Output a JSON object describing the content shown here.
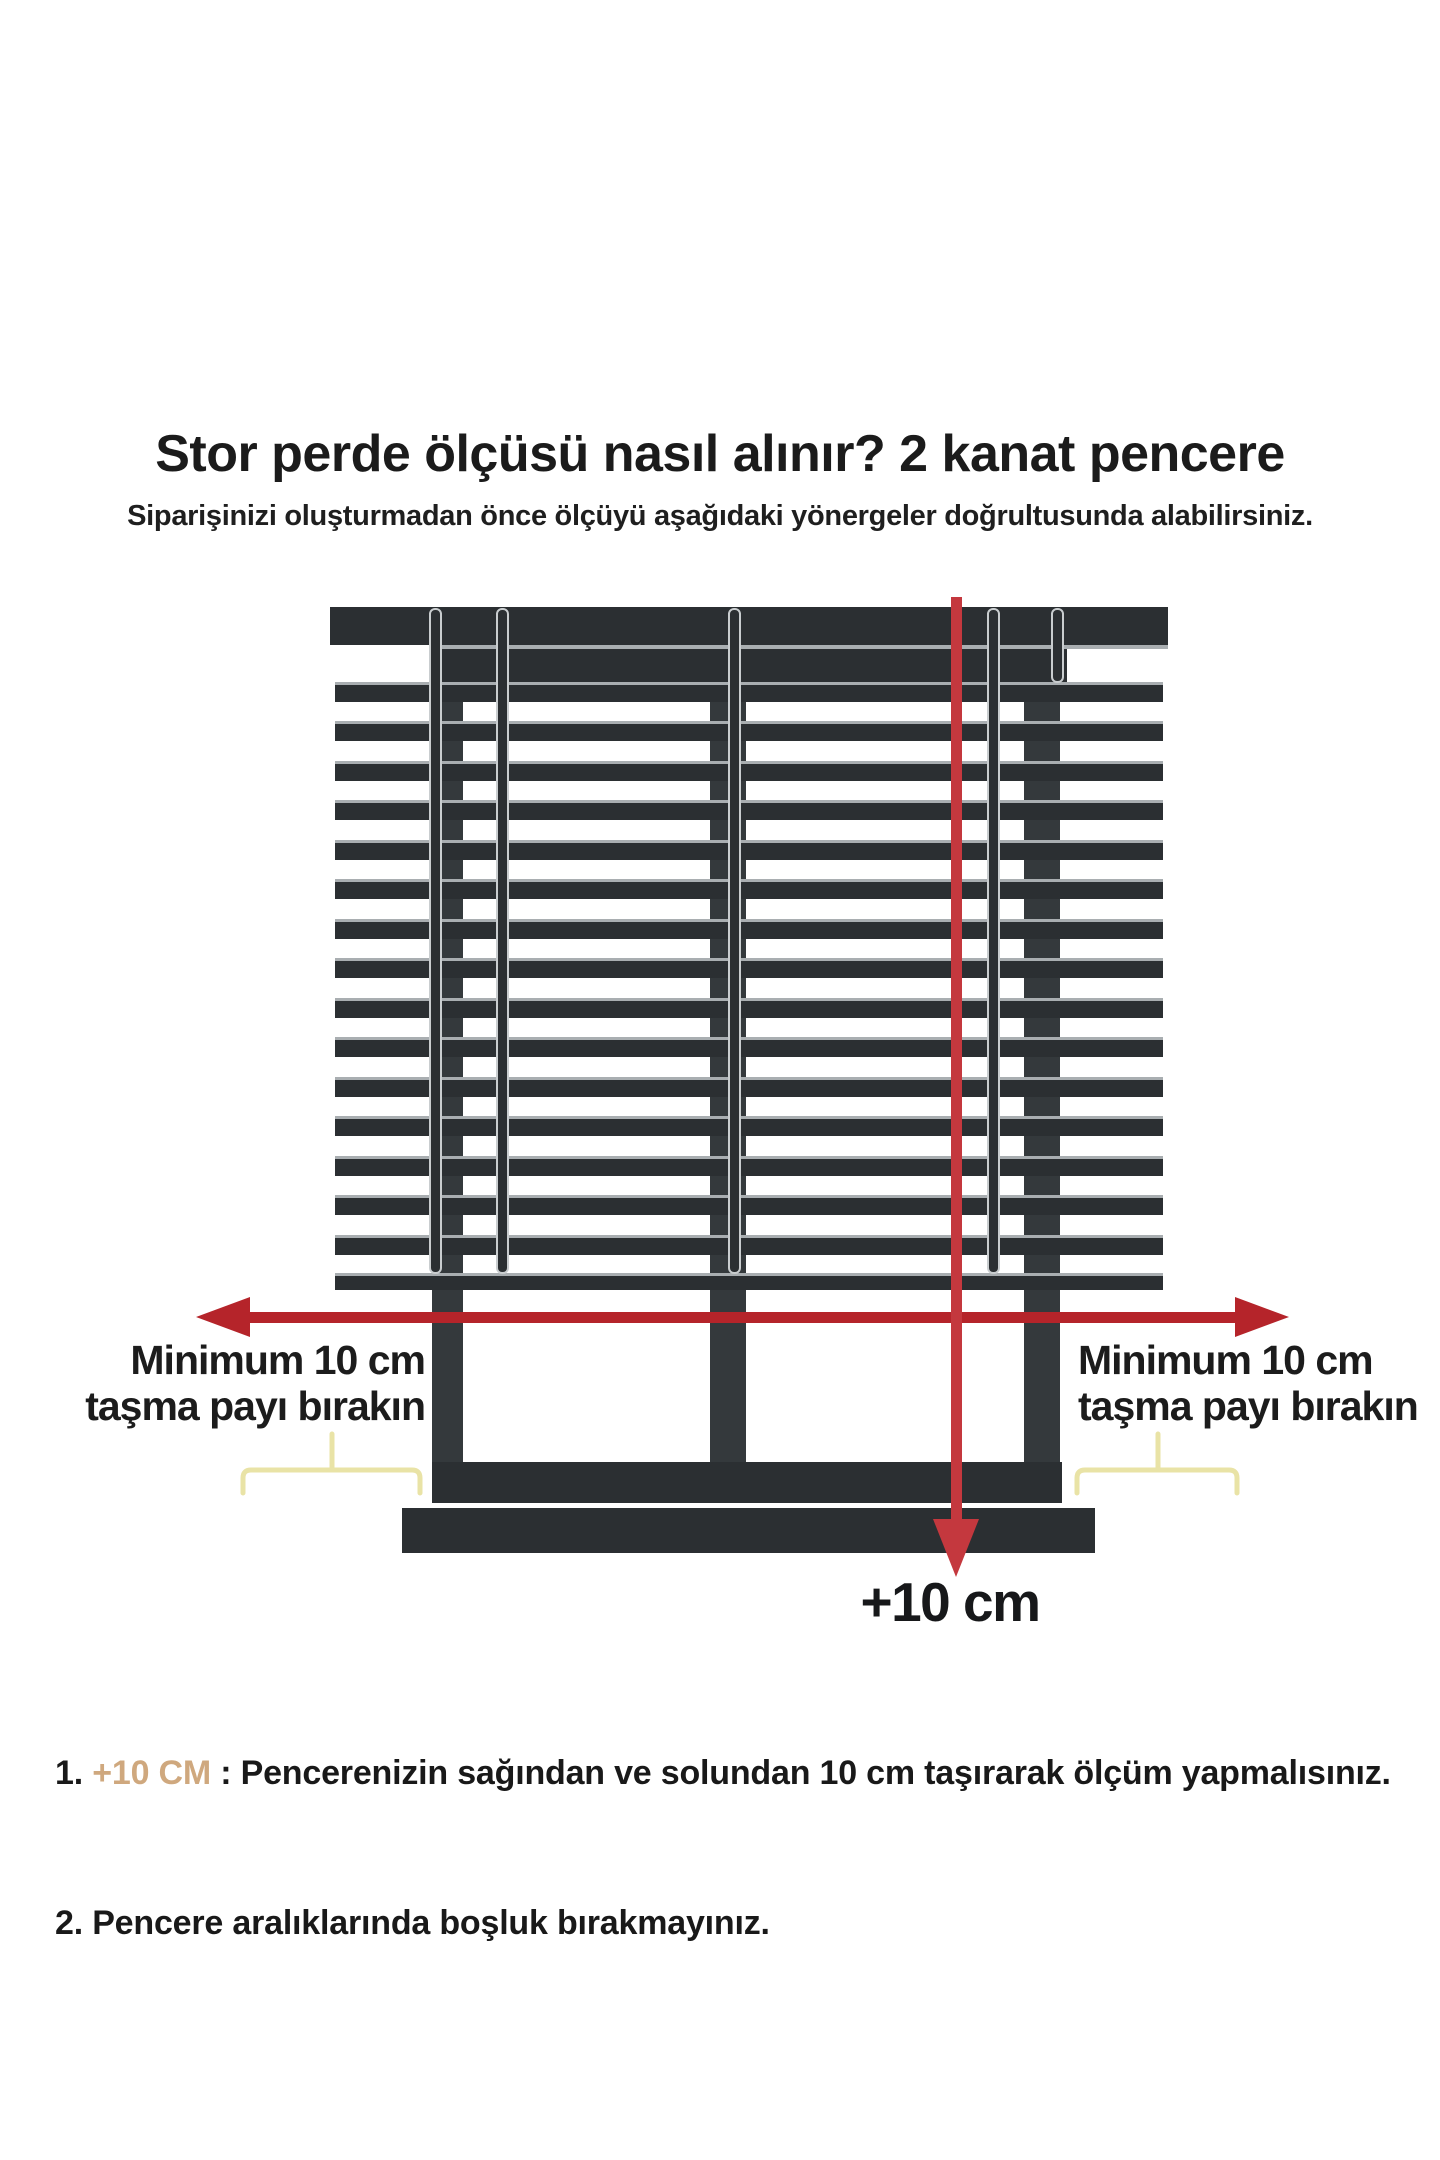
{
  "page": {
    "background_color": "#ffffff"
  },
  "header": {
    "title": "Stor perde ölçüsü nasıl alınır? 2 kanat pencere",
    "subtitle": "Siparişinizi oluşturmadan önce ölçüyü aşağıdaki yönergeler doğrultusunda alabilirsiniz."
  },
  "diagram": {
    "left_overhang_label": {
      "line1": "Minimum 10 cm",
      "line2": "taşma payı bırakın"
    },
    "right_overhang_label": {
      "line1": "Minimum 10 cm",
      "line2": "taşma payı bırakın"
    },
    "height_arrow_label": "+10 cm",
    "colors": {
      "frame_dark": "#2b2f32",
      "frame_mid": "#34393c",
      "slat_highlight": "#a9aeb1",
      "cord_outline": "#c9cdcf",
      "arrow_red": "#b5242a",
      "arrow_red_bright": "#c4383e",
      "brace_yellow": "#e9e3a6",
      "note_highlight_tan": "#cfa87e",
      "text_black": "#1b1b1b"
    }
  },
  "notes": [
    {
      "number": "1. ",
      "highlight": "+10 CM",
      "text": " : Pencerenizin sağından ve solundan 10 cm taşırarak ölçüm yapmalısınız."
    },
    {
      "number": "2. ",
      "highlight": "",
      "text": "Pencere aralıklarında boşluk bırakmayınız."
    }
  ]
}
